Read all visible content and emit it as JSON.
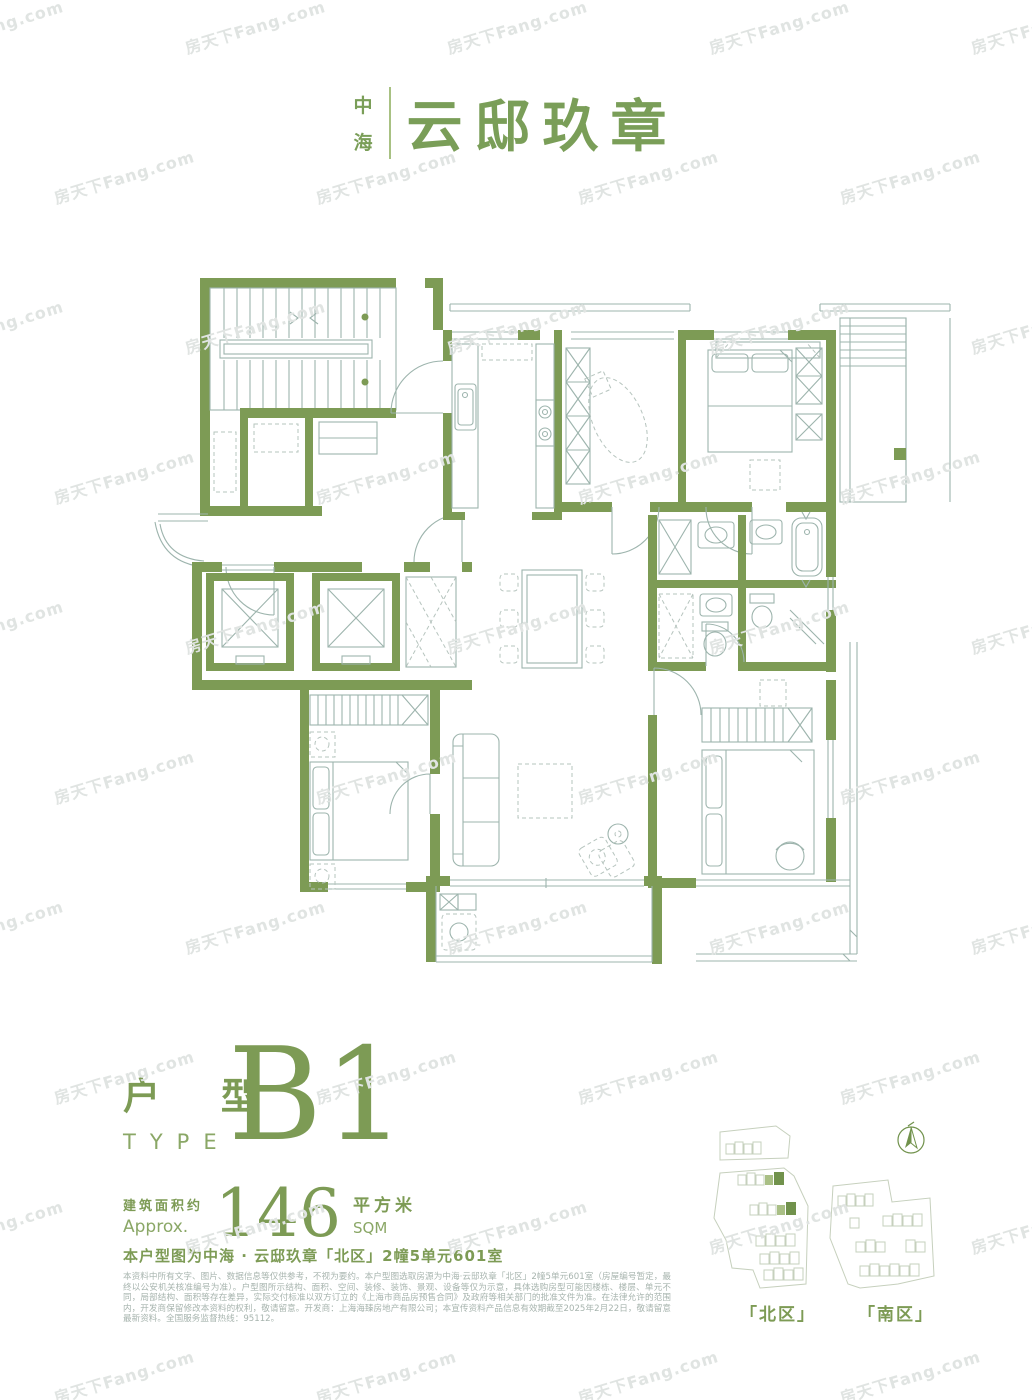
{
  "watermark": {
    "text": "房天下Fang.com"
  },
  "logo": {
    "prefix_top": "中",
    "prefix_bottom": "海",
    "name": "云邸玖章"
  },
  "type_block": {
    "cn": "户 型",
    "en": "TYPE",
    "code": "B1"
  },
  "area_block": {
    "label_cn": "建筑面积约",
    "label_en": "Approx.",
    "value": "146",
    "unit_cn": "平方米",
    "unit_en": "SQM"
  },
  "unit_note": "本户型图为中海 · 云邸玖章「北区」2幢5单元601室",
  "disclaimer": "本资料中所有文字、图片、数据信息等仅供参考，不视为要约。本户型图选取房源为中海·云邸玖章「北区」2幢5单元601室（房屋编号暂定，最终以公安机关核准编号为准）。户型图所示结构、面积、空间、装修、装饰、景观、设备等仅为示意，具体选购房型可能因楼栋、楼层、单元不同，局部结构、面积等存在差异，实际交付标准以双方订立的《上海市商品房预售合同》及政府等相关部门的批准文件为准。在法律允许的范围内，开发商保留修改本资料的权利，敬请留意。开发商：上海海臻房地产有限公司；本宣传资料产品信息有效期截至2025年2月22日，敬请留意最新资料。全国服务监督热线：95112。",
  "siteplan": {
    "north_label": "「北区」",
    "south_label": "「南区」"
  },
  "colors": {
    "brand_green": "#7d9b55",
    "logo_green": "#7a9e58",
    "line": "#9db4ad",
    "dash": "#b6c4be",
    "text_gray": "#a7b4ae",
    "hl_light": "#a9bf85",
    "hl_dark": "#71924c",
    "site_line": "#c6d0bd"
  }
}
